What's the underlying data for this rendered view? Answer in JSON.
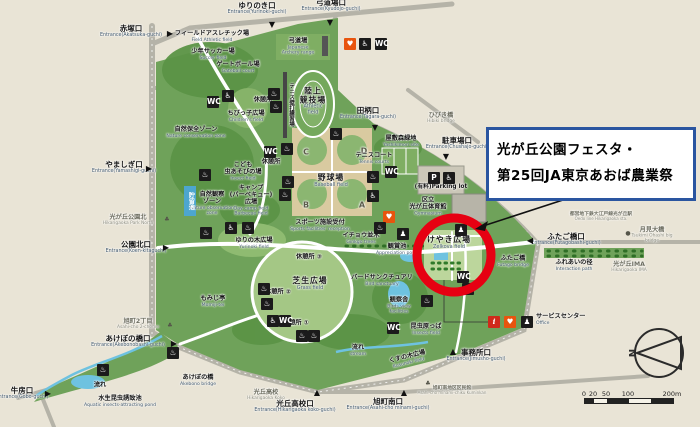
{
  "callout": {
    "line1": "光が丘公園フェスタ・",
    "line2": "第25回JA東京あおば農業祭",
    "border_color": "#2a55a0"
  },
  "highlight": {
    "color": "#e60012"
  },
  "legend": {
    "north": "N",
    "scale": {
      "labels": [
        {
          "t": "0",
          "x": 0
        },
        {
          "t": "20",
          "x": 9
        },
        {
          "t": "50",
          "x": 22
        },
        {
          "t": "100",
          "x": 44
        },
        {
          "t": "200m",
          "x": 88
        }
      ],
      "segments": [
        {
          "x": 0,
          "w": 9,
          "c": "#222"
        },
        {
          "x": 9,
          "w": 13,
          "c": "#f5f2e8"
        },
        {
          "x": 22,
          "w": 22,
          "c": "#222"
        },
        {
          "x": 44,
          "w": 22,
          "c": "#f5f2e8"
        },
        {
          "x": 66,
          "w": 22,
          "c": "#222"
        }
      ]
    }
  },
  "map": {
    "labels": [
      {
        "n": "entrance-akatsuka",
        "jp": "赤塚口",
        "en": "Entrance(Akatsuka-guchi)",
        "x": 131,
        "y": 32,
        "c": "entrance"
      },
      {
        "n": "entrance-yurinoki",
        "jp": "ゆりのき口",
        "en": "Entrance(Yurinoki-guchi)",
        "x": 257,
        "y": 9,
        "c": "entrance"
      },
      {
        "n": "entrance-kyudojo",
        "jp": "弓道場口",
        "en": "Entrance(Kyudojo-guchi)",
        "x": 331,
        "y": 6,
        "c": "entrance"
      },
      {
        "n": "entrance-yamashigi",
        "jp": "やましぎ口",
        "en": "Entrance(Yamashigi-guchi)",
        "x": 124,
        "y": 168,
        "c": "entrance"
      },
      {
        "n": "entrance-koen-kita",
        "jp": "公園北口",
        "en": "Entrance(Koen-kitaguchi)",
        "x": 136,
        "y": 248,
        "c": "entrance"
      },
      {
        "n": "entrance-akebonobashi",
        "jp": "あけぼの橋口",
        "en": "Entrance(Akebonobashi-guchi)",
        "x": 128,
        "y": 342,
        "c": "entrance"
      },
      {
        "n": "entrance-tagara",
        "jp": "田柄口",
        "en": "Entrance(Tagara-guchi)",
        "x": 368,
        "y": 114,
        "c": "entrance"
      },
      {
        "n": "entrance-chushajo",
        "jp": "駐車場口",
        "en": "Entrance(Chushajo-guchi)",
        "x": 457,
        "y": 144,
        "c": "entrance"
      },
      {
        "n": "entrance-futagobashi",
        "jp": "ふたご橋口",
        "en": "Entrance(Futagobashi-guchi)",
        "x": 566,
        "y": 240,
        "c": "entrance"
      },
      {
        "n": "entrance-jimusho",
        "jp": "事務所口",
        "en": "Entrance(Jimusho-guchi)",
        "x": 476,
        "y": 356,
        "c": "entrance"
      },
      {
        "n": "entrance-hikarigaoka-koko",
        "jp": "光丘高校口",
        "en": "Entrance(Hikarigaoka koko-guchi)",
        "x": 295,
        "y": 407,
        "c": "entrance"
      },
      {
        "n": "entrance-asahicho-minami",
        "jp": "旭町南口",
        "en": "Entrance(Asahi-cho minami-guchi)",
        "x": 388,
        "y": 405,
        "c": "entrance"
      },
      {
        "n": "entrance-gobo",
        "jp": "牛房口",
        "en": "Entrance(Gobo-guchi)",
        "x": 22,
        "y": 394,
        "c": "entrance"
      },
      {
        "n": "field-athletic",
        "jp": "フィールドアスレチック場",
        "en": "Field Athletic field",
        "x": 212,
        "y": 37,
        "c": "facility"
      },
      {
        "n": "soccer-field",
        "jp": "少年サッカー場",
        "en": "Soccer field",
        "x": 213,
        "y": 55,
        "c": "facility"
      },
      {
        "n": "gateball-court",
        "jp": "ゲートボール場",
        "en": "Gateball court",
        "x": 238,
        "y": 68,
        "c": "facility"
      },
      {
        "n": "archery-range",
        "jp": "弓道場",
        "en": "Japanese\nArchery range",
        "x": 298,
        "y": 47,
        "c": "facility"
      },
      {
        "n": "athletic-field",
        "jp": "陸上\n競技場",
        "en": "Athletic\nfield",
        "x": 313,
        "y": 102,
        "c": "area"
      },
      {
        "n": "tennis-wall",
        "jp": "テニス壁打練習場",
        "en": "",
        "x": 291,
        "y": 105,
        "c": "vertical"
      },
      {
        "n": "baseball-field",
        "jp": "野球場",
        "en": "Baseball field",
        "x": 331,
        "y": 181,
        "c": "area"
      },
      {
        "n": "quad-c",
        "jp": "C",
        "en": "",
        "x": 306,
        "y": 153,
        "c": "quad"
      },
      {
        "n": "quad-d",
        "jp": "D",
        "en": "",
        "x": 364,
        "y": 152,
        "c": "quad"
      },
      {
        "n": "quad-b",
        "jp": "B",
        "en": "",
        "x": 306,
        "y": 206,
        "c": "quad"
      },
      {
        "n": "quad-a",
        "jp": "A",
        "en": "",
        "x": 362,
        "y": 206,
        "c": "quad"
      },
      {
        "n": "tennis-courts",
        "jp": "テニスコート",
        "en": "Tennis courts",
        "x": 374,
        "y": 159,
        "c": "facility"
      },
      {
        "n": "chibikko-hiroba",
        "jp": "ちびっ子広場",
        "en": "Children's field",
        "x": 246,
        "y": 117,
        "c": "facility"
      },
      {
        "n": "kyukeisho-5",
        "jp": "休憩所",
        "en": "",
        "x": 263,
        "y": 101,
        "c": "facility"
      },
      {
        "n": "nature-conservation",
        "jp": "自然保全ゾーン",
        "en": "Nature conservation zone",
        "x": 196,
        "y": 133,
        "c": "facility"
      },
      {
        "n": "insect-field",
        "jp": "こども\n虫あそびの場",
        "en": "Insect field",
        "x": 243,
        "y": 172,
        "c": "facility"
      },
      {
        "n": "kyukeisho-4",
        "jp": "休憩所",
        "en": "",
        "x": 271,
        "y": 163,
        "c": "facility"
      },
      {
        "n": "camp-field",
        "jp": "キャンプ\n(バーベキュー)\n広場",
        "en": "Day camp field\nBarbecue field",
        "x": 251,
        "y": 201,
        "c": "facility"
      },
      {
        "n": "nature-observation",
        "jp": "自然観察\nゾーン",
        "en": "Nature observation\nzone",
        "x": 212,
        "y": 204,
        "c": "facility"
      },
      {
        "n": "choryu-pond",
        "jp": "貯留池",
        "en": "",
        "x": 190,
        "y": 201,
        "c": "pondv"
      },
      {
        "n": "hikarigaoka-park-north",
        "jp": "光が丘公園北",
        "en": "Hikarigaoka Park North",
        "x": 128,
        "y": 221,
        "c": "outside"
      },
      {
        "n": "sports-reception",
        "jp": "スポーツ施設受付",
        "en": "Sports facilities' reception",
        "x": 320,
        "y": 226,
        "c": "facility"
      },
      {
        "n": "yurinoki-field",
        "jp": "ゆりの木広場",
        "en": "Yurinoki field",
        "x": 254,
        "y": 244,
        "c": "facility"
      },
      {
        "n": "ginkgo-trees",
        "jp": "イチョウ並木",
        "en": "Ginkgo trees",
        "x": 361,
        "y": 239,
        "c": "facility"
      },
      {
        "n": "kansho-pond",
        "jp": "観賞池",
        "en": "Appreciation pond",
        "x": 397,
        "y": 250,
        "c": "facility"
      },
      {
        "n": "keyaki-hiroba",
        "jp": "けやき広場",
        "en": "Zelkova field",
        "x": 449,
        "y": 243,
        "c": "area"
      },
      {
        "n": "yashikimori",
        "jp": "屋敷森緑地",
        "en": "Yashikimori site",
        "x": 401,
        "y": 142,
        "c": "facility"
      },
      {
        "n": "parking-lot",
        "jp": "(有料)Parking lot",
        "en": "",
        "x": 441,
        "y": 187,
        "c": "plain"
      },
      {
        "n": "gymnasium",
        "jp": "区立\n光が丘体育館",
        "en": "Gymnasium",
        "x": 428,
        "y": 207,
        "c": "facility"
      },
      {
        "n": "shibafu-hiroba",
        "jp": "芝生広場",
        "en": "Grass field",
        "x": 310,
        "y": 284,
        "c": "area"
      },
      {
        "n": "bird-sanctuary",
        "jp": "バードサンクチュアリ",
        "en": "Bird sanctuary",
        "x": 382,
        "y": 281,
        "c": "facility"
      },
      {
        "n": "kansatsusha",
        "jp": "観察舎",
        "en": "Birds view\nfacilities",
        "x": 399,
        "y": 306,
        "c": "facility"
      },
      {
        "n": "konchu-harappa",
        "jp": "昆虫原っぱ",
        "en": "Insects field",
        "x": 426,
        "y": 330,
        "c": "facility"
      },
      {
        "n": "kusunoki-hiroba",
        "jp": "くすの木広場",
        "en": "Kusunoki field",
        "x": 408,
        "y": 360,
        "c": "facility rot15"
      },
      {
        "n": "momiji-tei",
        "jp": "もみじ亭",
        "en": "Momiji-tei",
        "x": 213,
        "y": 302,
        "c": "facility"
      },
      {
        "n": "kyukeisho-1",
        "jp": "休憩所 ①",
        "en": "",
        "x": 296,
        "y": 324,
        "c": "facility"
      },
      {
        "n": "kyukeisho-2",
        "jp": "休憩所 ②",
        "en": "",
        "x": 278,
        "y": 293,
        "c": "facility"
      },
      {
        "n": "kyukeisho-3",
        "jp": "休憩所 ③",
        "en": "",
        "x": 309,
        "y": 258,
        "c": "facility"
      },
      {
        "n": "nagare-sw",
        "jp": "流れ",
        "en": "",
        "x": 100,
        "y": 386,
        "c": "facility"
      },
      {
        "n": "nagare-s",
        "jp": "流れ",
        "en": "stream",
        "x": 358,
        "y": 351,
        "c": "facility"
      },
      {
        "n": "asahicho-2chome",
        "jp": "旭町2丁目",
        "en": "Asahi-cho 2-chome",
        "x": 138,
        "y": 325,
        "c": "outside"
      },
      {
        "n": "akebono-bridge",
        "jp": "あけぼの橋",
        "en": "Akebono bridge",
        "x": 198,
        "y": 381,
        "c": "facility"
      },
      {
        "n": "aquatic-pond",
        "jp": "水生昆虫誘致池",
        "en": "Aquatic insects-attracting pond",
        "x": 120,
        "y": 402,
        "c": "facility"
      },
      {
        "n": "hikarigaoka-koko",
        "jp": "光丘高校",
        "en": "Hikarigaoka Koko",
        "x": 266,
        "y": 396,
        "c": "outside"
      },
      {
        "n": "kuminkan",
        "jp": "旭町南地区区民館",
        "en": "Asahi-cho minami-chiku Kuminkan",
        "x": 452,
        "y": 391,
        "c": "tiny"
      },
      {
        "n": "hibiki-bridge",
        "jp": "ひびき橋",
        "en": "Hibiki bridge",
        "x": 441,
        "y": 119,
        "c": "outside"
      },
      {
        "n": "oedo-line-station",
        "jp": "都営地下鉄大江戸線光が丘駅",
        "en": "Oedo line Hikarigaoka sta.",
        "x": 601,
        "y": 217,
        "c": "tiny"
      },
      {
        "n": "tsukimi-ohashi",
        "jp": "月見大橋",
        "en": "Tsukimi Ohashi big bridge",
        "x": 652,
        "y": 236,
        "c": "outside"
      },
      {
        "n": "futago-bridge",
        "jp": "ふたご橋",
        "en": "Futago bridge",
        "x": 513,
        "y": 262,
        "c": "facility"
      },
      {
        "n": "fureai-path",
        "jp": "ふれあいの径",
        "en": "Interaction path",
        "x": 574,
        "y": 266,
        "c": "facility"
      },
      {
        "n": "hikarigaoka-ima",
        "jp": "光が丘IMA",
        "en": "Hikarigaoka IMA",
        "x": 629,
        "y": 268,
        "c": "outside"
      },
      {
        "n": "service-center",
        "jp": "サービスセンター",
        "en": "Office",
        "x": 536,
        "y": 320,
        "c": "facility left"
      }
    ],
    "markers": [
      {
        "n": "akatsuka-marker",
        "g": "▶",
        "x": 170,
        "y": 34
      },
      {
        "n": "yurinoki-marker",
        "g": "▼",
        "x": 272,
        "y": 25
      },
      {
        "n": "kyudojo-marker",
        "g": "▼",
        "x": 330,
        "y": 23
      },
      {
        "n": "yamashigi-marker",
        "g": "▶",
        "x": 149,
        "y": 169
      },
      {
        "n": "koen-kita-marker",
        "g": "▶",
        "x": 166,
        "y": 248
      },
      {
        "n": "akebonobashi-marker",
        "g": "▶",
        "x": 174,
        "y": 344
      },
      {
        "n": "tagara-marker",
        "g": "▼",
        "x": 375,
        "y": 128
      },
      {
        "n": "chushajo-marker",
        "g": "▼",
        "x": 446,
        "y": 157
      },
      {
        "n": "futagobashi-marker",
        "g": "◀",
        "x": 530,
        "y": 241
      },
      {
        "n": "jimusho-marker",
        "g": "▲",
        "x": 453,
        "y": 352
      },
      {
        "n": "koko-marker",
        "g": "▲",
        "x": 317,
        "y": 393
      },
      {
        "n": "asahicho-minami-marker",
        "g": "▲",
        "x": 404,
        "y": 393
      },
      {
        "n": "gobo-marker",
        "g": "▶",
        "x": 48,
        "y": 394
      },
      {
        "n": "tree-park-north",
        "g": "♣",
        "x": 167,
        "y": 220,
        "s": 1
      },
      {
        "n": "tree-asahicho",
        "g": "♣",
        "x": 170,
        "y": 326,
        "s": 1
      },
      {
        "n": "tree-kuminkan",
        "g": "♣",
        "x": 428,
        "y": 384,
        "s": 1
      },
      {
        "n": "dot-tsukimi",
        "g": "●",
        "x": 628,
        "y": 234,
        "s": 1
      }
    ],
    "icons": [
      {
        "n": "aed-icon",
        "g": "♥",
        "x": 350,
        "y": 44,
        "t": "aed"
      },
      {
        "n": "wheelchair-icon",
        "g": "♿",
        "x": 365,
        "y": 44,
        "t": ""
      },
      {
        "n": "toilet-icon",
        "g": "WC",
        "x": 381,
        "y": 44,
        "t": ""
      },
      {
        "n": "toilet-icon",
        "g": "WC",
        "x": 213,
        "y": 102,
        "t": ""
      },
      {
        "n": "wheelchair-icon",
        "g": "♿",
        "x": 228,
        "y": 96,
        "t": ""
      },
      {
        "n": "fountain-icon",
        "g": "♨",
        "x": 274,
        "y": 94,
        "t": ""
      },
      {
        "n": "fountain-icon",
        "g": "♨",
        "x": 276,
        "y": 107,
        "t": ""
      },
      {
        "n": "toilet-icon",
        "g": "WC",
        "x": 270,
        "y": 152,
        "t": ""
      },
      {
        "n": "fountain-icon",
        "g": "♨",
        "x": 287,
        "y": 149,
        "t": ""
      },
      {
        "n": "fountain-icon",
        "g": "♨",
        "x": 205,
        "y": 175,
        "t": ""
      },
      {
        "n": "fountain-icon",
        "g": "♨",
        "x": 288,
        "y": 182,
        "t": ""
      },
      {
        "n": "fountain-icon",
        "g": "♨",
        "x": 285,
        "y": 195,
        "t": ""
      },
      {
        "n": "wheelchair-icon",
        "g": "♿",
        "x": 231,
        "y": 228,
        "t": ""
      },
      {
        "n": "fountain-icon",
        "g": "♨",
        "x": 248,
        "y": 228,
        "t": ""
      },
      {
        "n": "fountain-icon",
        "g": "♨",
        "x": 206,
        "y": 233,
        "t": ""
      },
      {
        "n": "fountain-icon",
        "g": "♨",
        "x": 336,
        "y": 134,
        "t": ""
      },
      {
        "n": "fountain-icon",
        "g": "♨",
        "x": 373,
        "y": 177,
        "t": ""
      },
      {
        "n": "wheelchair-icon",
        "g": "♿",
        "x": 373,
        "y": 196,
        "t": ""
      },
      {
        "n": "toilet-icon",
        "g": "WC",
        "x": 391,
        "y": 172,
        "t": ""
      },
      {
        "n": "parking-icon",
        "g": "P",
        "x": 434,
        "y": 178,
        "t": ""
      },
      {
        "n": "parking-accessible-icon",
        "g": "♿",
        "x": 449,
        "y": 178,
        "t": ""
      },
      {
        "n": "aed-icon",
        "g": "♥",
        "x": 389,
        "y": 217,
        "t": "aed"
      },
      {
        "n": "fountain-icon",
        "g": "♨",
        "x": 380,
        "y": 228,
        "t": ""
      },
      {
        "n": "facility-icon",
        "g": "♟",
        "x": 403,
        "y": 234,
        "t": ""
      },
      {
        "n": "facility-icon",
        "g": "♟",
        "x": 461,
        "y": 230,
        "t": ""
      },
      {
        "n": "toilet-icon",
        "g": "WC",
        "x": 463,
        "y": 277,
        "t": ""
      },
      {
        "n": "wheelchair-icon",
        "g": "♿",
        "x": 468,
        "y": 289,
        "t": ""
      },
      {
        "n": "fountain-icon",
        "g": "♨",
        "x": 427,
        "y": 301,
        "t": ""
      },
      {
        "n": "toilet-icon",
        "g": "WC",
        "x": 393,
        "y": 328,
        "t": ""
      },
      {
        "n": "fountain-icon",
        "g": "♨",
        "x": 264,
        "y": 289,
        "t": ""
      },
      {
        "n": "fountain-icon",
        "g": "♨",
        "x": 267,
        "y": 304,
        "t": ""
      },
      {
        "n": "wheelchair-icon",
        "g": "♿",
        "x": 273,
        "y": 321,
        "t": ""
      },
      {
        "n": "toilet-icon",
        "g": "WC",
        "x": 285,
        "y": 321,
        "t": ""
      },
      {
        "n": "fountain-icon",
        "g": "♨",
        "x": 302,
        "y": 336,
        "t": ""
      },
      {
        "n": "fountain-icon",
        "g": "♨",
        "x": 314,
        "y": 336,
        "t": ""
      },
      {
        "n": "fountain-icon",
        "g": "♨",
        "x": 173,
        "y": 353,
        "t": ""
      },
      {
        "n": "fountain-icon",
        "g": "♨",
        "x": 103,
        "y": 370,
        "t": ""
      },
      {
        "n": "info-icon",
        "g": "i",
        "x": 494,
        "y": 322,
        "t": "info"
      },
      {
        "n": "aed-icon",
        "g": "♥",
        "x": 510,
        "y": 322,
        "t": "aed"
      },
      {
        "n": "office-icon",
        "g": "♟",
        "x": 527,
        "y": 322,
        "t": ""
      }
    ]
  }
}
